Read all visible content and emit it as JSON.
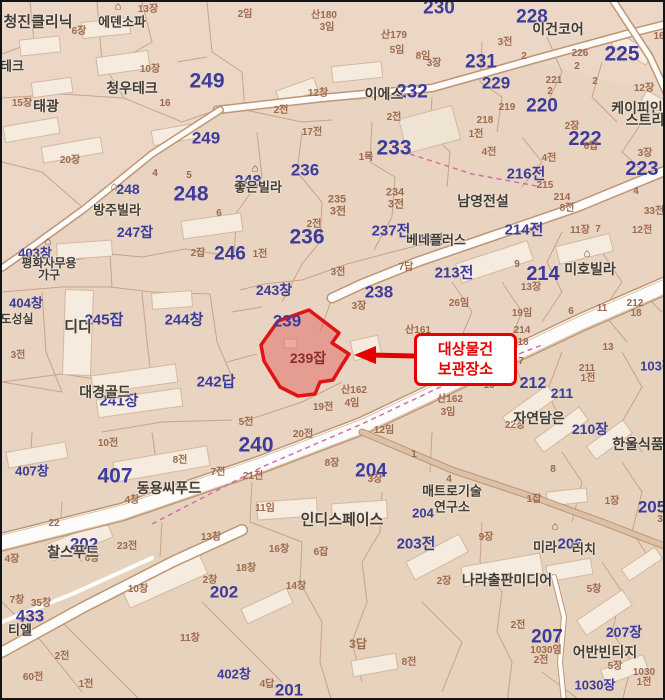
{
  "map": {
    "type": "korean-cadastral-map",
    "colors": {
      "ground": "#e9d4c1",
      "parcel_line": "#c49a7e",
      "road_fill": "#fdfcfa",
      "blue_number": "#3c3c9c",
      "brown_number": "#9c6a4e",
      "poi_name": "#423c37",
      "highlight_fill": "#e05050",
      "highlight_stroke": "#e01414",
      "callout_red": "#e60000",
      "boundary_dash": "#d66fa8"
    }
  },
  "highlight": {
    "parcel_label": "239잡",
    "label_x": 306,
    "label_y": 356,
    "polygon": "307,308 337,331 330,341 347,352 340,363 331,378 318,380 313,392 296,394 278,385 262,359 259,343 276,319"
  },
  "callout": {
    "line1": "대상물건",
    "line2": "보관장소",
    "box": {
      "x": 412,
      "y": 331,
      "w": 97,
      "h": 47
    },
    "arrow_tip_x": 352,
    "arrow_tip_y": 353
  },
  "labels": {
    "blue": [
      [
        "249",
        205,
        79,
        21
      ],
      [
        "249",
        204,
        136,
        17
      ],
      [
        "248",
        126,
        187,
        14
      ],
      [
        "248",
        189,
        192,
        21
      ],
      [
        "248",
        246,
        180,
        16
      ],
      [
        "246",
        228,
        252,
        19
      ],
      [
        "247잡",
        133,
        230,
        14
      ],
      [
        "245잡",
        102,
        318,
        15
      ],
      [
        "244창",
        182,
        318,
        15
      ],
      [
        "243창",
        272,
        288,
        14
      ],
      [
        "240",
        254,
        443,
        21
      ],
      [
        "241장",
        117,
        399,
        15
      ],
      [
        "242답",
        214,
        380,
        15
      ],
      [
        "236",
        303,
        168,
        17
      ],
      [
        "236",
        305,
        235,
        21
      ],
      [
        "238",
        377,
        290,
        17
      ],
      [
        "239",
        285,
        319,
        17
      ],
      [
        "237전",
        389,
        229,
        15
      ],
      [
        "233",
        392,
        146,
        21
      ],
      [
        "232",
        410,
        90,
        19
      ],
      [
        "231",
        479,
        60,
        19
      ],
      [
        "230",
        437,
        6,
        19
      ],
      [
        "229",
        494,
        81,
        17
      ],
      [
        "228",
        530,
        15,
        19
      ],
      [
        "225",
        620,
        52,
        21
      ],
      [
        "223",
        640,
        167,
        20
      ],
      [
        "222",
        583,
        137,
        20
      ],
      [
        "220",
        540,
        104,
        19
      ],
      [
        "216전",
        524,
        172,
        15
      ],
      [
        "214전",
        522,
        228,
        15
      ],
      [
        "214",
        541,
        272,
        20
      ],
      [
        "213전",
        452,
        271,
        15
      ],
      [
        "212",
        531,
        382,
        16
      ],
      [
        "211",
        560,
        391,
        14
      ],
      [
        "210장",
        588,
        427,
        14
      ],
      [
        "204",
        369,
        469,
        19
      ],
      [
        "204",
        421,
        511,
        13
      ],
      [
        "203전",
        414,
        542,
        15
      ],
      [
        "202",
        82,
        542,
        17
      ],
      [
        "202",
        222,
        590,
        17
      ],
      [
        "201",
        287,
        688,
        17
      ],
      [
        "207",
        545,
        635,
        19
      ],
      [
        "207장",
        622,
        630,
        14
      ],
      [
        "206",
        568,
        542,
        15
      ],
      [
        "205",
        650,
        505,
        17
      ],
      [
        "1030장",
        593,
        683,
        13
      ],
      [
        "403창",
        33,
        251,
        13
      ],
      [
        "404창",
        24,
        301,
        13
      ],
      [
        "407창",
        30,
        469,
        13
      ],
      [
        "407",
        113,
        474,
        21
      ],
      [
        "433",
        28,
        614,
        17
      ],
      [
        "402창",
        232,
        672,
        13
      ],
      [
        "13전",
        429,
        237,
        12
      ],
      [
        "103장",
        655,
        364,
        13
      ]
    ],
    "brown": [
      [
        "13장",
        146,
        8
      ],
      [
        "6장",
        77,
        30
      ],
      [
        "10장",
        148,
        68
      ],
      [
        "15장",
        20,
        102
      ],
      [
        "16",
        163,
        102
      ],
      [
        "20장",
        68,
        159
      ],
      [
        "2임",
        243,
        13
      ],
      [
        "산180",
        322,
        14
      ],
      [
        "3임",
        325,
        26
      ],
      [
        "산179",
        392,
        34
      ],
      [
        "5임",
        395,
        49
      ],
      [
        "8임",
        421,
        55
      ],
      [
        "3장",
        432,
        62
      ],
      [
        "12창",
        316,
        92
      ],
      [
        "2전",
        279,
        109
      ],
      [
        "2전",
        392,
        116
      ],
      [
        "17전",
        310,
        131
      ],
      [
        "1목",
        364,
        156
      ],
      [
        "3전",
        503,
        41
      ],
      [
        "2",
        522,
        55
      ],
      [
        "226",
        578,
        52
      ],
      [
        "2",
        575,
        65
      ],
      [
        "2",
        593,
        80
      ],
      [
        "221",
        552,
        79
      ],
      [
        "2",
        548,
        90
      ],
      [
        "219",
        505,
        106
      ],
      [
        "218",
        483,
        119
      ],
      [
        "1전",
        474,
        133
      ],
      [
        "4전",
        487,
        151
      ],
      [
        "12장",
        642,
        87
      ],
      [
        "16",
        657,
        35
      ],
      [
        "2장",
        570,
        125
      ],
      [
        "6답",
        589,
        145
      ],
      [
        "3장",
        643,
        152
      ],
      [
        "4전",
        547,
        157
      ],
      [
        "215",
        543,
        184
      ],
      [
        "214",
        560,
        196
      ],
      [
        "8전",
        565,
        207
      ],
      [
        "4",
        634,
        190
      ],
      [
        "33전",
        652,
        210
      ],
      [
        "11장",
        578,
        229
      ],
      [
        "7",
        596,
        228
      ],
      [
        "12전",
        640,
        229
      ],
      [
        "9",
        515,
        263
      ],
      [
        "13장",
        529,
        286
      ],
      [
        "26임",
        457,
        302
      ],
      [
        "19임",
        520,
        312
      ],
      [
        "6",
        569,
        310
      ],
      [
        "11",
        600,
        307
      ],
      [
        "212",
        633,
        302
      ],
      [
        "18",
        634,
        312
      ],
      [
        "13",
        606,
        346
      ],
      [
        "7",
        519,
        360
      ],
      [
        "214",
        520,
        329
      ],
      [
        "18",
        521,
        341
      ],
      [
        "산161",
        416,
        329
      ],
      [
        "3장",
        357,
        305
      ],
      [
        "산162",
        352,
        389
      ],
      [
        "4임",
        350,
        402
      ],
      [
        "19전",
        321,
        406
      ],
      [
        "산162",
        448,
        398
      ],
      [
        "3임",
        446,
        411
      ],
      [
        "2잡",
        196,
        252
      ],
      [
        "1전",
        258,
        253
      ],
      [
        "2전",
        312,
        223
      ],
      [
        "235",
        335,
        198,
        11
      ],
      [
        "3전",
        336,
        210,
        11
      ],
      [
        "234",
        393,
        191,
        11
      ],
      [
        "3전",
        394,
        203,
        11
      ],
      [
        "7답",
        404,
        266
      ],
      [
        "3전",
        336,
        271
      ],
      [
        "4",
        153,
        172
      ],
      [
        "5",
        187,
        174
      ],
      [
        "6",
        217,
        212
      ],
      [
        "20전",
        301,
        433
      ],
      [
        "5전",
        244,
        421
      ],
      [
        "12임",
        382,
        429
      ],
      [
        "8장",
        330,
        462
      ],
      [
        "21전",
        251,
        475
      ],
      [
        "1",
        412,
        453
      ],
      [
        "10전",
        106,
        442
      ],
      [
        "8전",
        178,
        459
      ],
      [
        "7전",
        216,
        471
      ],
      [
        "3전",
        16,
        354
      ],
      [
        "11임",
        263,
        507
      ],
      [
        "3장",
        373,
        478
      ],
      [
        "1잡",
        532,
        498
      ],
      [
        "1장",
        610,
        500
      ],
      [
        "9장",
        484,
        536
      ],
      [
        "16",
        487,
        384
      ],
      [
        "211",
        585,
        367
      ],
      [
        "1전",
        586,
        377
      ],
      [
        "22장",
        513,
        424
      ],
      [
        "8",
        551,
        468
      ],
      [
        "4",
        447,
        478
      ],
      [
        "16창",
        277,
        548
      ],
      [
        "6잡",
        319,
        551
      ],
      [
        "18창",
        244,
        567
      ],
      [
        "14창",
        294,
        585
      ],
      [
        "2장",
        442,
        580
      ],
      [
        "4창",
        130,
        499
      ],
      [
        "22",
        52,
        522
      ],
      [
        "23전",
        125,
        545
      ],
      [
        "13창",
        209,
        536
      ],
      [
        "6창",
        90,
        557
      ],
      [
        "10창",
        136,
        588
      ],
      [
        "2창",
        208,
        579
      ],
      [
        "4장",
        10,
        558
      ],
      [
        "7창",
        15,
        599
      ],
      [
        "35창",
        39,
        602
      ],
      [
        "2전",
        60,
        655
      ],
      [
        "60전",
        31,
        676
      ],
      [
        "1전",
        84,
        683
      ],
      [
        "11창",
        188,
        637
      ],
      [
        "3답",
        356,
        642,
        12
      ],
      [
        "8전",
        407,
        661
      ],
      [
        "4답",
        265,
        683
      ],
      [
        "2전",
        516,
        624
      ],
      [
        "1030임",
        544,
        649
      ],
      [
        "2전",
        539,
        659
      ],
      [
        "5장",
        613,
        665
      ],
      [
        "1030",
        642,
        671
      ],
      [
        "1전",
        642,
        681
      ],
      [
        "5창",
        592,
        588
      ],
      [
        "3",
        658,
        518
      ]
    ],
    "names": [
      [
        "청진클리닉",
        36,
        20,
        15
      ],
      [
        "에덴소파",
        120,
        20,
        13
      ],
      [
        "청우테크",
        130,
        86,
        14
      ],
      [
        "태광",
        44,
        104,
        14
      ],
      [
        "테크",
        10,
        64,
        13
      ],
      [
        "이에스",
        382,
        92,
        14
      ],
      [
        "이건코어",
        556,
        27,
        14
      ],
      [
        "케이피인",
        635,
        106,
        14
      ],
      [
        "스트리",
        643,
        118,
        14
      ],
      [
        "남영전설",
        481,
        199,
        14
      ],
      [
        "베네플러스",
        434,
        238,
        13
      ],
      [
        "미호빌라",
        588,
        267,
        14
      ],
      [
        "방주빌라",
        115,
        208,
        13
      ],
      [
        "평화사무용",
        47,
        261,
        12
      ],
      [
        "가구",
        47,
        273,
        12
      ],
      [
        "디디",
        76,
        325,
        15
      ],
      [
        "도성실",
        15,
        317,
        12
      ],
      [
        "대경골드",
        103,
        390,
        14
      ],
      [
        "동용씨푸드",
        167,
        486,
        14
      ],
      [
        "인디스페이스",
        340,
        518,
        15
      ],
      [
        "매트로기술",
        450,
        489,
        13
      ],
      [
        "연구소",
        450,
        505,
        13
      ],
      [
        "자연담은",
        537,
        416,
        14
      ],
      [
        "한울식품",
        636,
        442,
        14
      ],
      [
        "찰스푸드",
        71,
        550,
        14
      ],
      [
        "좋은빌라",
        256,
        185,
        13
      ],
      [
        "나라출판미디어",
        505,
        578,
        14
      ],
      [
        "어반빈티지",
        603,
        650,
        14
      ],
      [
        "미라",
        543,
        545,
        13
      ],
      [
        "러치",
        582,
        547,
        13
      ],
      [
        "티엘",
        18,
        628,
        13
      ]
    ],
    "icons": [
      [
        116,
        5
      ],
      [
        253,
        167
      ],
      [
        112,
        185
      ],
      [
        46,
        240
      ],
      [
        585,
        252
      ],
      [
        553,
        525
      ]
    ]
  }
}
